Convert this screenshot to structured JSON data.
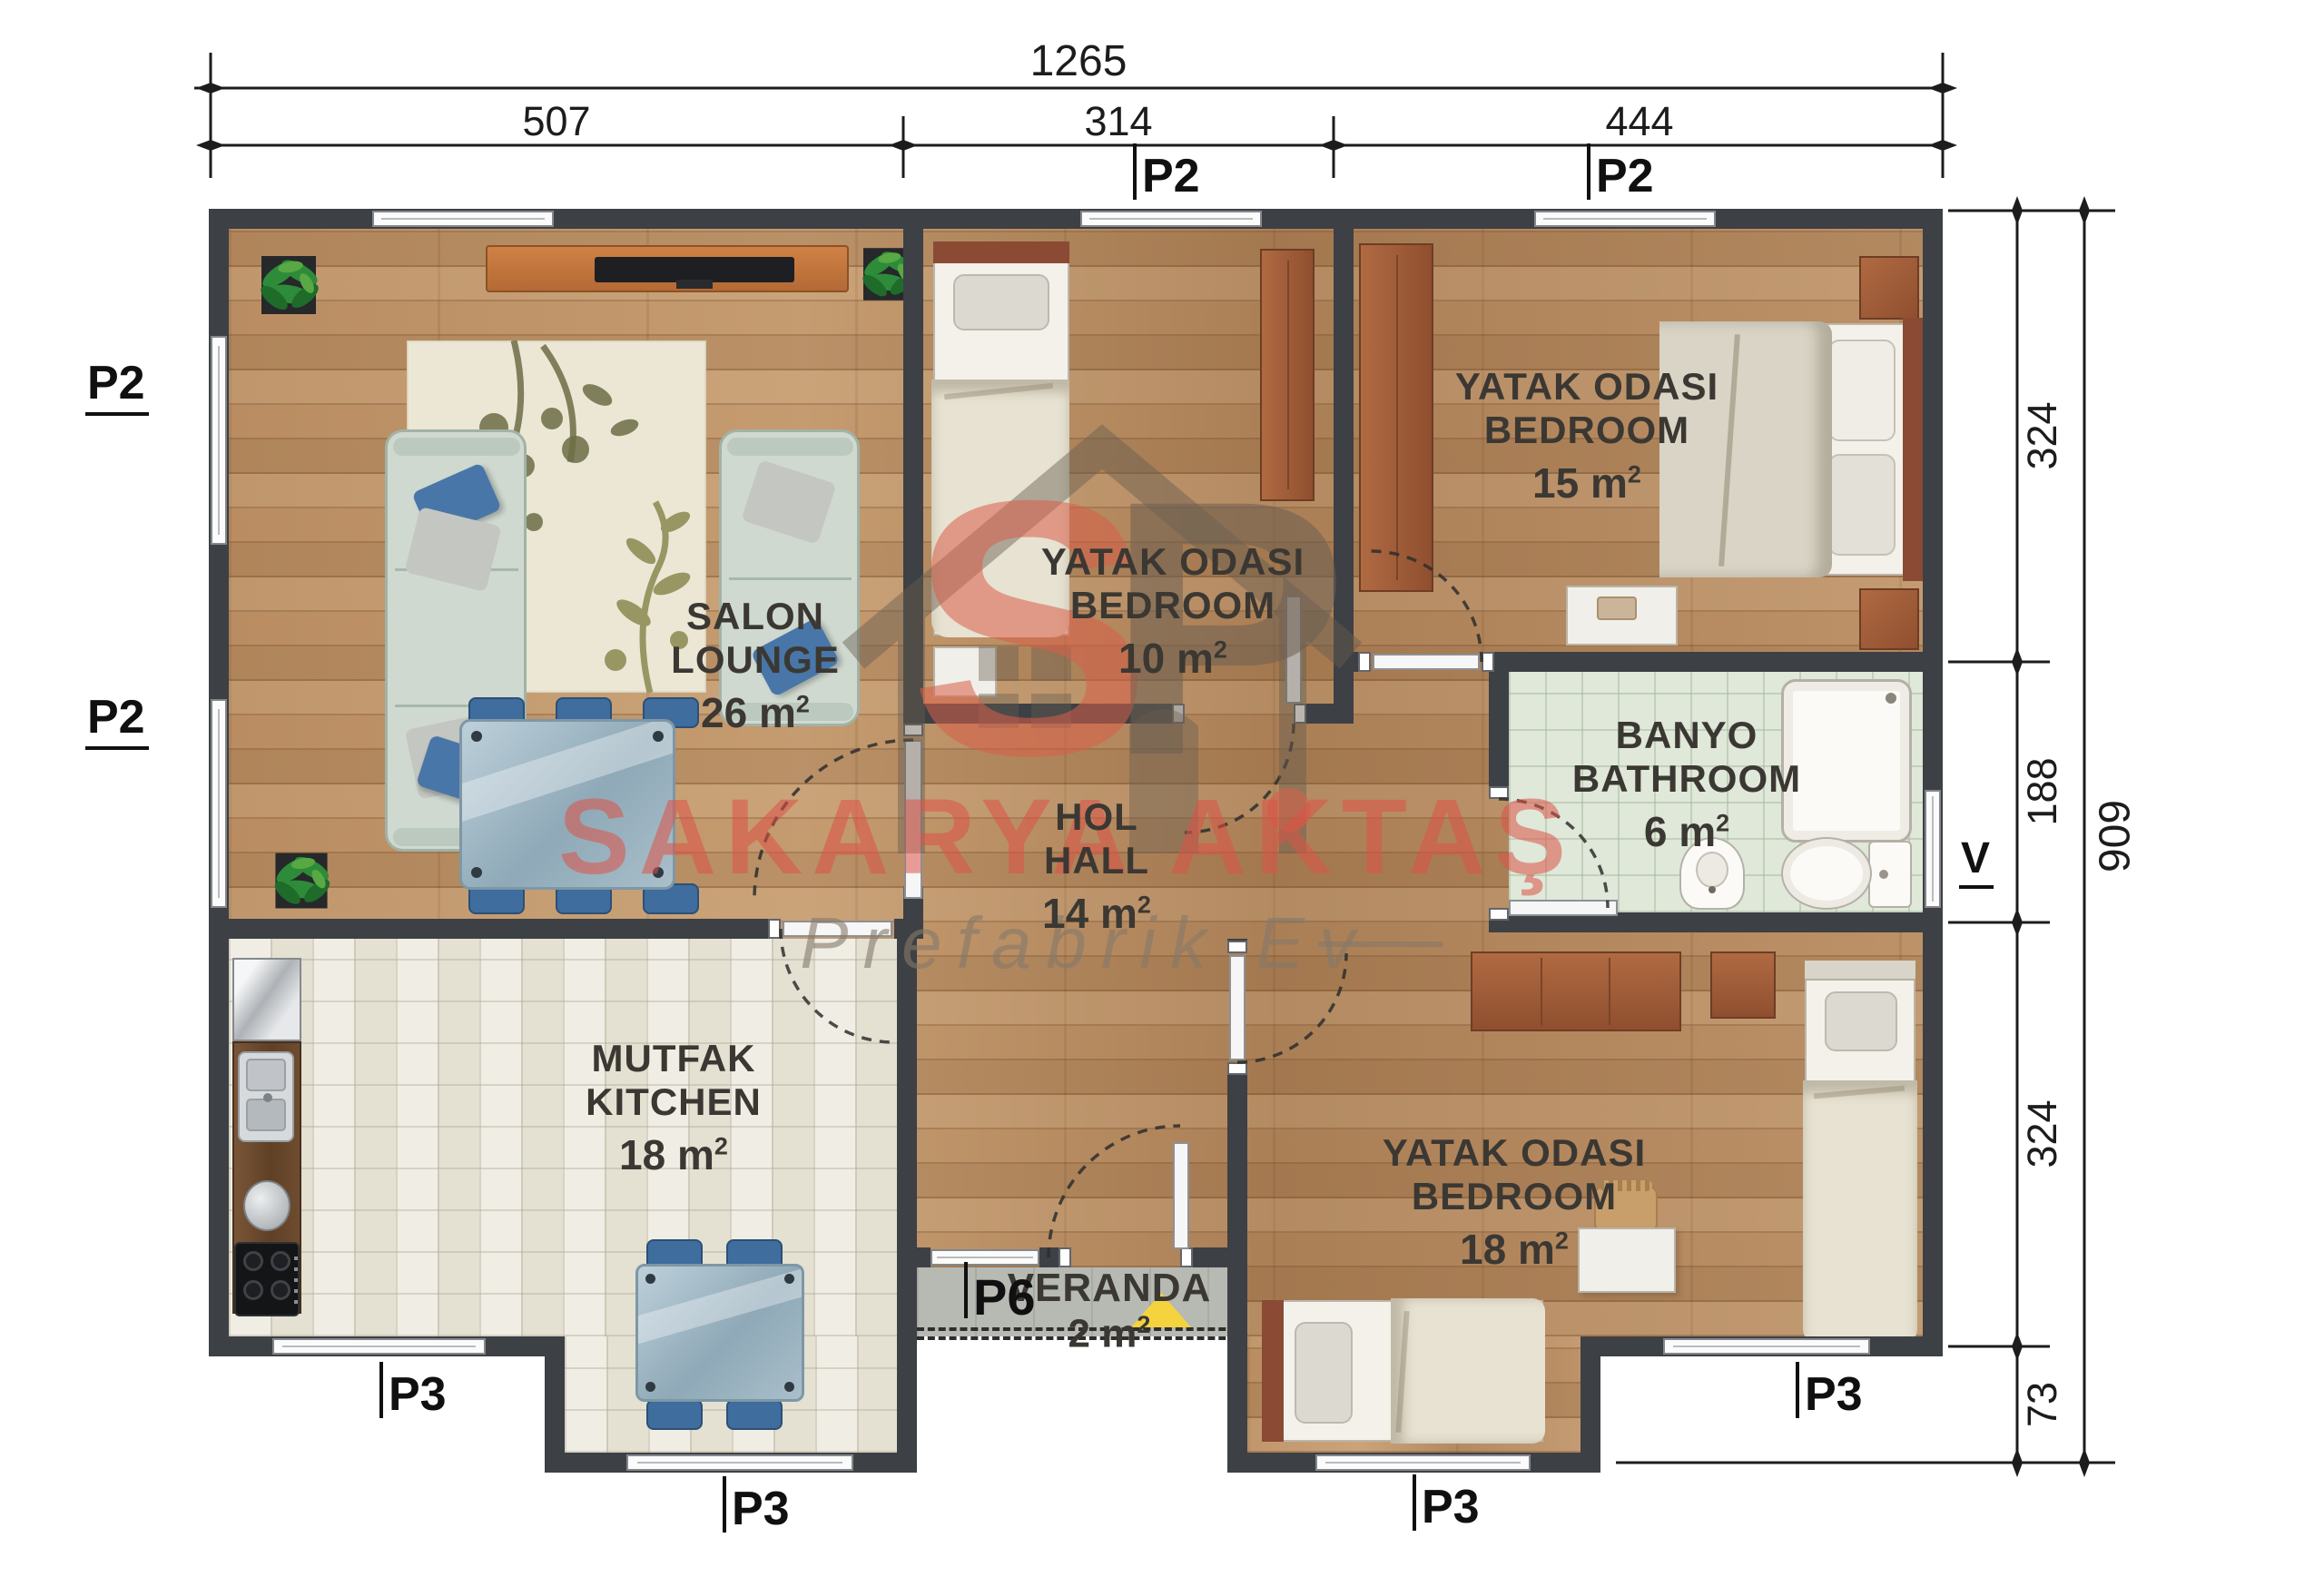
{
  "dimensions": {
    "top": {
      "total": "1265",
      "segments": [
        "507",
        "314",
        "444"
      ]
    },
    "right": {
      "segments": [
        "324",
        "188",
        "324",
        "73"
      ],
      "total": "909"
    }
  },
  "units": {
    "label": "m",
    "sup": "2"
  },
  "rooms": {
    "salon": {
      "name_tr": "SALON",
      "name_en": "LOUNGE",
      "area": "26"
    },
    "bedroom10": {
      "name_tr": "YATAK ODASI",
      "name_en": "BEDROOM",
      "area": "10"
    },
    "bedroom15": {
      "name_tr": "YATAK ODASI",
      "name_en": "BEDROOM",
      "area": "15"
    },
    "bathroom": {
      "name_tr": "BANYO",
      "name_en": "BATHROOM",
      "area": "6"
    },
    "hall": {
      "name_tr": "HOL",
      "name_en": "HALL",
      "area": "14"
    },
    "kitchen": {
      "name_tr": "MUTFAK",
      "name_en": "KITCHEN",
      "area": "18"
    },
    "bedroom18": {
      "name_tr": "YATAK ODASI",
      "name_en": "BEDROOM",
      "area": "18"
    },
    "veranda": {
      "name": "VERANDA",
      "area": "2"
    }
  },
  "panel_labels": {
    "p2_left_top": "P2",
    "p2_left_bottom": "P2",
    "p2_top_bedroom10": "P2",
    "p2_top_bedroom15": "P2",
    "p3_kitchen": "P3",
    "p3_kitchen_bump": "P3",
    "p3_bedroom_bump": "P3",
    "p3_bedroom_right": "P3",
    "p6_veranda": "P6",
    "v_bathroom": "V"
  },
  "watermark": {
    "logo_s": "S",
    "logo_p": "P",
    "brand": "SAKARYA AKTAŞ",
    "tagline": "Prefabrik Ev"
  },
  "colors": {
    "wall": "#3d4045",
    "wood_floor": "#b5895e",
    "kitchen_tile": "#e9e6d9",
    "bath_tile": "#dfe8d9",
    "veranda_gray": "#b7bab2",
    "brand_red": "#dd5347",
    "highlight_yellow": "#f5d33f",
    "furniture_blue": "#3e6d9e",
    "wardrobe_brown": "#a0583a"
  }
}
